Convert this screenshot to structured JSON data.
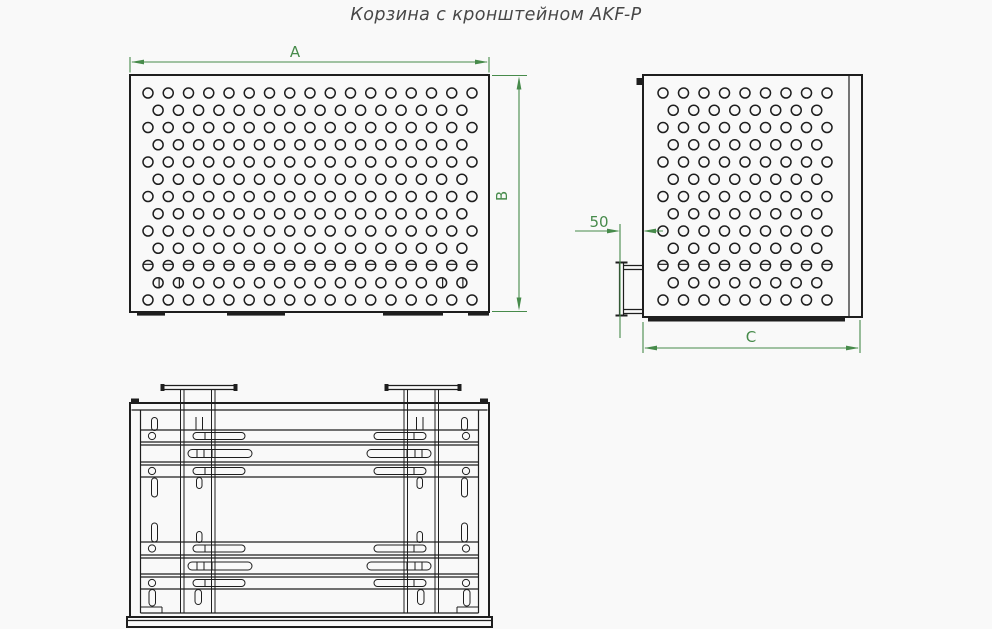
{
  "title": "Корзина с кронштейном AKF-P",
  "colors": {
    "dimension_green": "#478b4b",
    "line_dark": "#1e1e1e",
    "background": "#f9f9f9"
  },
  "dimensions": {
    "width_label": "A",
    "height_label": "B",
    "bracket_offset_label": "50",
    "depth_label": "C"
  },
  "views": {
    "front": {
      "name": "front view",
      "dim_horizontal": "A",
      "dim_vertical": "B"
    },
    "side": {
      "name": "side view with wall bracket",
      "dim_offset": "50",
      "dim_depth": "C"
    },
    "top": {
      "name": "top view with mounting brackets"
    }
  },
  "hole_pattern": {
    "front": {
      "rows": 13,
      "cols_odd": 17,
      "cols_even": 16,
      "hole_radius": 5
    },
    "side": {
      "rows": 13,
      "cols_odd": 9,
      "cols_even": 8,
      "hole_radius": 5
    }
  }
}
